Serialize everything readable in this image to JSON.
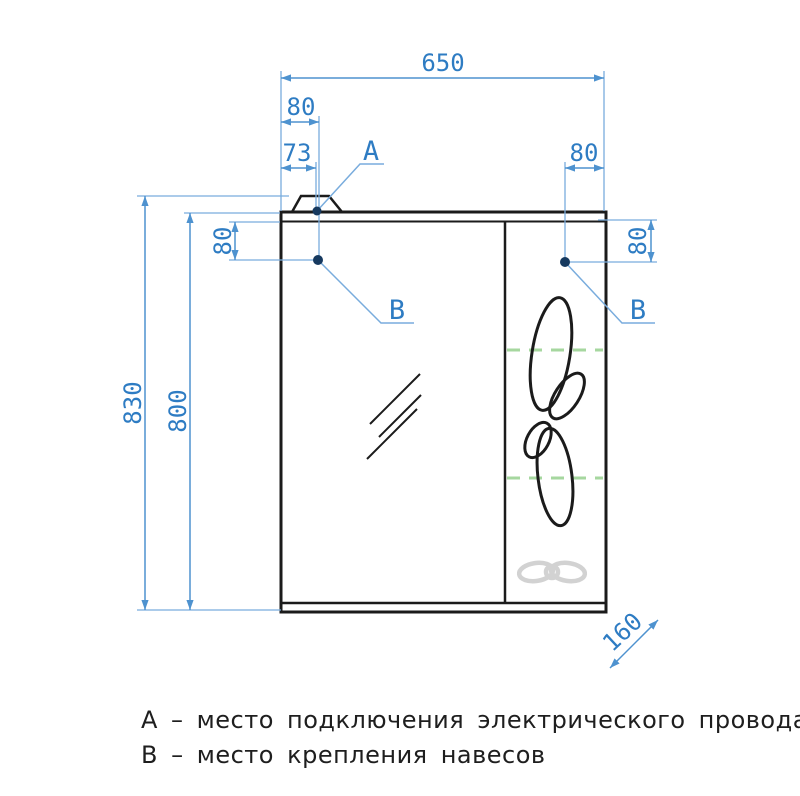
{
  "drawing": {
    "dims": {
      "width": "650",
      "top_left_offset": "80",
      "lamp_offset": "73",
      "top_right_offset": "80",
      "height_overall": "830",
      "height_body": "800",
      "hinge_left": "80",
      "hinge_right": "80",
      "depth": "160"
    },
    "callouts": {
      "a": "А",
      "b_left": "В",
      "b_right": "В"
    },
    "legend": {
      "line_a": "А – место подключения электрического провода",
      "line_b": "В – место крепления навесов"
    },
    "colors": {
      "dimension_blue": "#2e7cc3",
      "line_blue": "#4e92cf",
      "outline_black": "#1b1b1b",
      "shelf_green": "#a6d79f",
      "decor_gray": "#d2d2d2"
    }
  }
}
